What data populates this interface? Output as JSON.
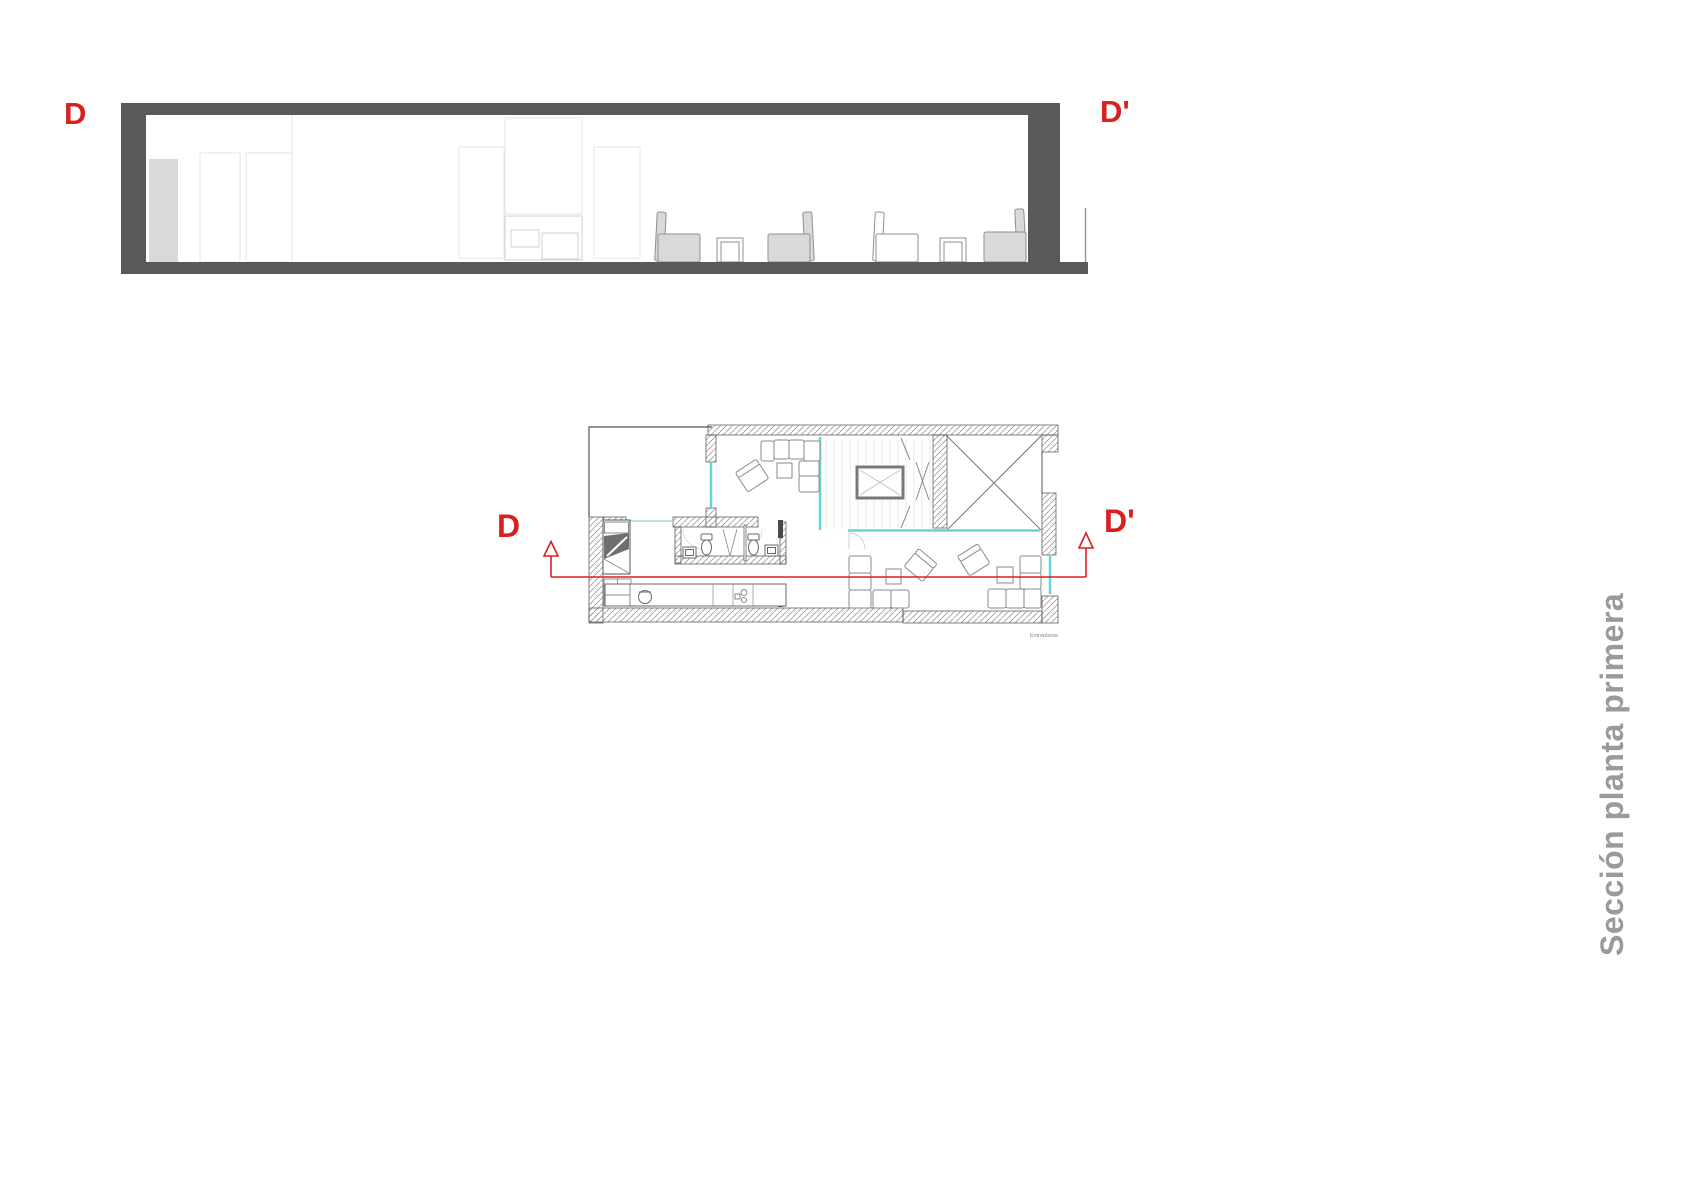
{
  "side_title": "Sección planta primera",
  "section": {
    "label_left": "D",
    "label_right": "D'"
  },
  "plan": {
    "label_left": "D",
    "label_right": "D'",
    "caption": "Entreplanta"
  },
  "colors": {
    "marker_red": "#d7201f",
    "section_frame_gray": "#595959",
    "glass_cyan": "#66d4d2",
    "side_title_gray": "#9a9a9a",
    "furniture_fill_gray": "#d9d9d9"
  }
}
